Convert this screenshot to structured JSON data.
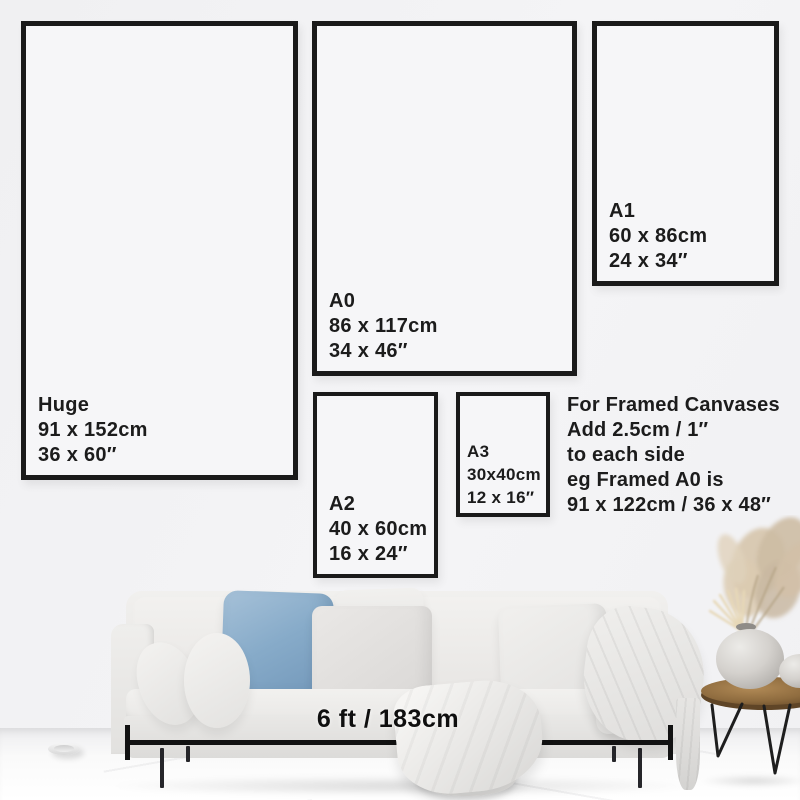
{
  "sizes": [
    {
      "name": "Huge",
      "cm": "91 x 152cm",
      "inches": "36 x 60″"
    },
    {
      "name": "A0",
      "cm": "86 x 117cm",
      "inches": "34 x 46″"
    },
    {
      "name": "A1",
      "cm": "60 x 86cm",
      "inches": "24 x 34″"
    },
    {
      "name": "A2",
      "cm": "40 x 60cm",
      "inches": "16 x 24″"
    },
    {
      "name": "A3",
      "cm": "30x40cm",
      "inches": "12 x 16″"
    }
  ],
  "framing_note": {
    "lines": [
      "For Framed Canvases",
      "Add 2.5cm / 1″",
      "to each side",
      "eg Framed A0 is",
      "91 x 122cm / 36 x 48″"
    ]
  },
  "sofa_measurement": "6 ft / 183cm",
  "colors": {
    "wall": "#f3f3f5",
    "frame_border": "#1a1a1a",
    "frame_fill": "#f6f6f8",
    "text": "#1c1c1c",
    "measure_line": "#121212",
    "blue_pillow": "#87abc9",
    "sofa_fabric": "#eae9e7",
    "table_wood": "#9a7749",
    "pampas": "#d3c2a9"
  }
}
